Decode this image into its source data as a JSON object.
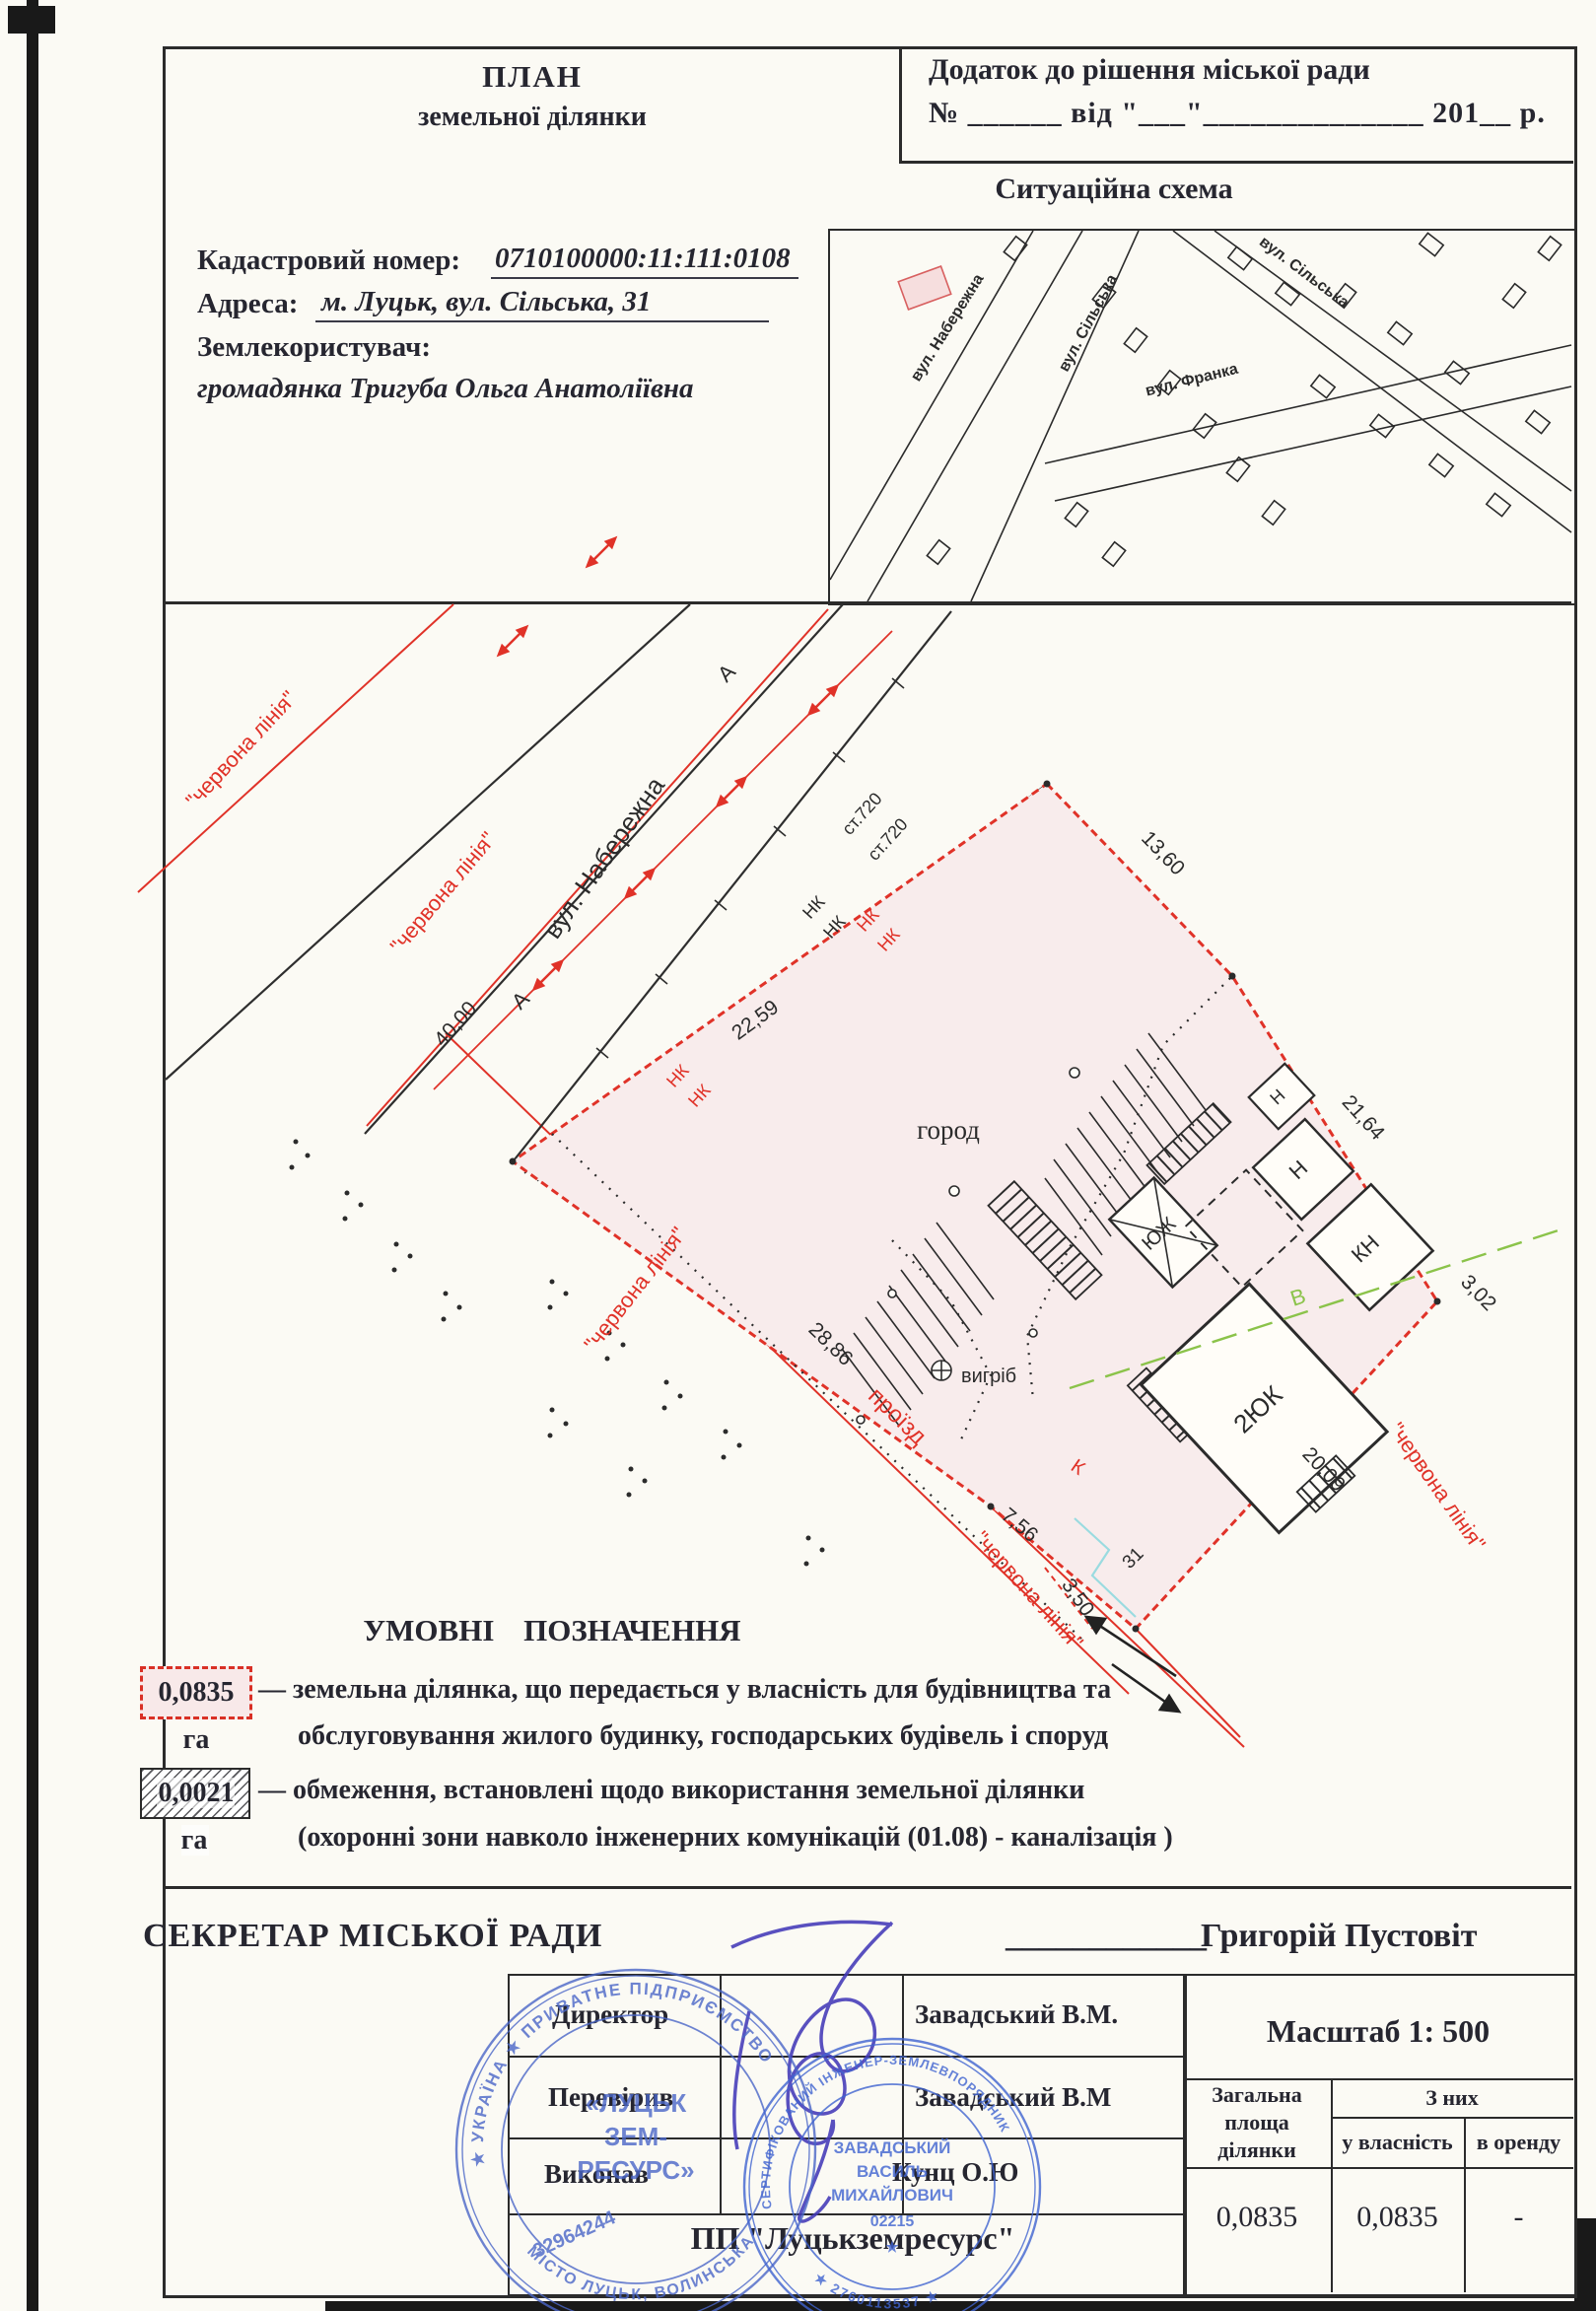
{
  "header": {
    "title_line1": "ПЛАН",
    "title_line2": "земельної ділянки",
    "annex_line1": "Додаток до рішення  міської ради",
    "annex_line2": "№ ______ від \"___\"______________ 201__ р."
  },
  "info": {
    "cadastral_label": "Кадастровий номер:",
    "cadastral_value": "0710100000:11:111:0108",
    "address_label": "Адреса:",
    "address_value": "м. Луцьк, вул. Сільська, 31",
    "landuser_label": "Землекористувач:",
    "landuser_value": "громадянка Тригуба Ольга Анатоліївна"
  },
  "situation": {
    "title": "Ситуаційна схема",
    "streets": {
      "naberezhna": "вул. Набережна",
      "silska": "вул. Сільська",
      "franka": "вул. Франка"
    }
  },
  "plan": {
    "street_naberezhna": "вул. Набережна",
    "red_line_label": "\"червона лінія\"",
    "proizd": "проїзд",
    "horod": "город",
    "vyhrib": "вигріб",
    "letter_a": "А",
    "letter_v": "В",
    "letter_k": "К",
    "nk": "НК",
    "st720": "ст.720",
    "house_number": "31",
    "dims": {
      "d4000": "40,00",
      "d2259": "22,59",
      "d1360": "13,60",
      "d2164": "21,64",
      "d302": "3,02",
      "d2009": "20,09",
      "d2886": "28,86",
      "d756": "7,56",
      "d350": "3,50"
    },
    "buildings": {
      "b_2yuk": "2ЮК",
      "b_yuzh": "ЮЖ",
      "b_kn": "КН",
      "b_n": "Н"
    }
  },
  "legend": {
    "title": "УМОВНІ ПОЗНАЧЕННЯ",
    "item1_area": "0,0835 га",
    "item1_line1": "— земельна ділянка, що передається у власність для  будівництва та",
    "item1_line2": "обслуговування жилого будинку, господарських будівель і споруд",
    "item2_area": "0,0021 га",
    "item2_line1": "— обмеження, встановлені щодо використання земельної ділянки",
    "item2_line2": "(охоронні зони навколо інженерних комунікацій (01.08) -  каналізація )"
  },
  "footer": {
    "secretary_label": "СЕКРЕТАР МІСЬКОЇ РАДИ",
    "secretary_underline": "____________",
    "secretary_name": "Григорій Пустовіт",
    "scale": "Масштаб  1: 500",
    "company": "ПП \"Луцькземресурс\"",
    "credits": [
      {
        "role": "Директор",
        "name": "Завадський В.М."
      },
      {
        "role": "Перевірив",
        "name": "Завадський  В.М"
      },
      {
        "role": "Виконав",
        "name": "Кунц О.Ю"
      }
    ],
    "area_table": {
      "col1_line1": "Загальна",
      "col1_line2": "площа",
      "col1_line3": "ділянки",
      "col23_header": "З них",
      "col2_sub": "у власність",
      "col3_sub": "в оренду",
      "total": "0,0835",
      "owned": "0,0835",
      "rented": "-"
    }
  },
  "stamps": {
    "stamp1": {
      "ring_top": "★ УКРАЇНА ★ ПРИВАТНЕ ПІДПРИЄМСТВО",
      "ring_bottom": "МІСТО ЛУЦЬК, ВОЛИНСЬКА ОБЛАСТЬ",
      "center1": "«ЛУЦЬК",
      "center2": "ЗЕМ-",
      "center3": "РЕСУРС»",
      "number": "32964244"
    },
    "stamp2": {
      "ring_top": "СЕРТИФІКОВАНИЙ ІНЖЕНЕР-ЗЕМЛЕВПОРЯДНИК",
      "ring_bottom": "★ 2760113537 ★",
      "line1": "ЗАВАДСЬКИЙ",
      "line2": "ВАСИЛЬ",
      "line3": "МИХАЙЛОВИЧ",
      "number": "02215",
      "star": "★"
    }
  }
}
